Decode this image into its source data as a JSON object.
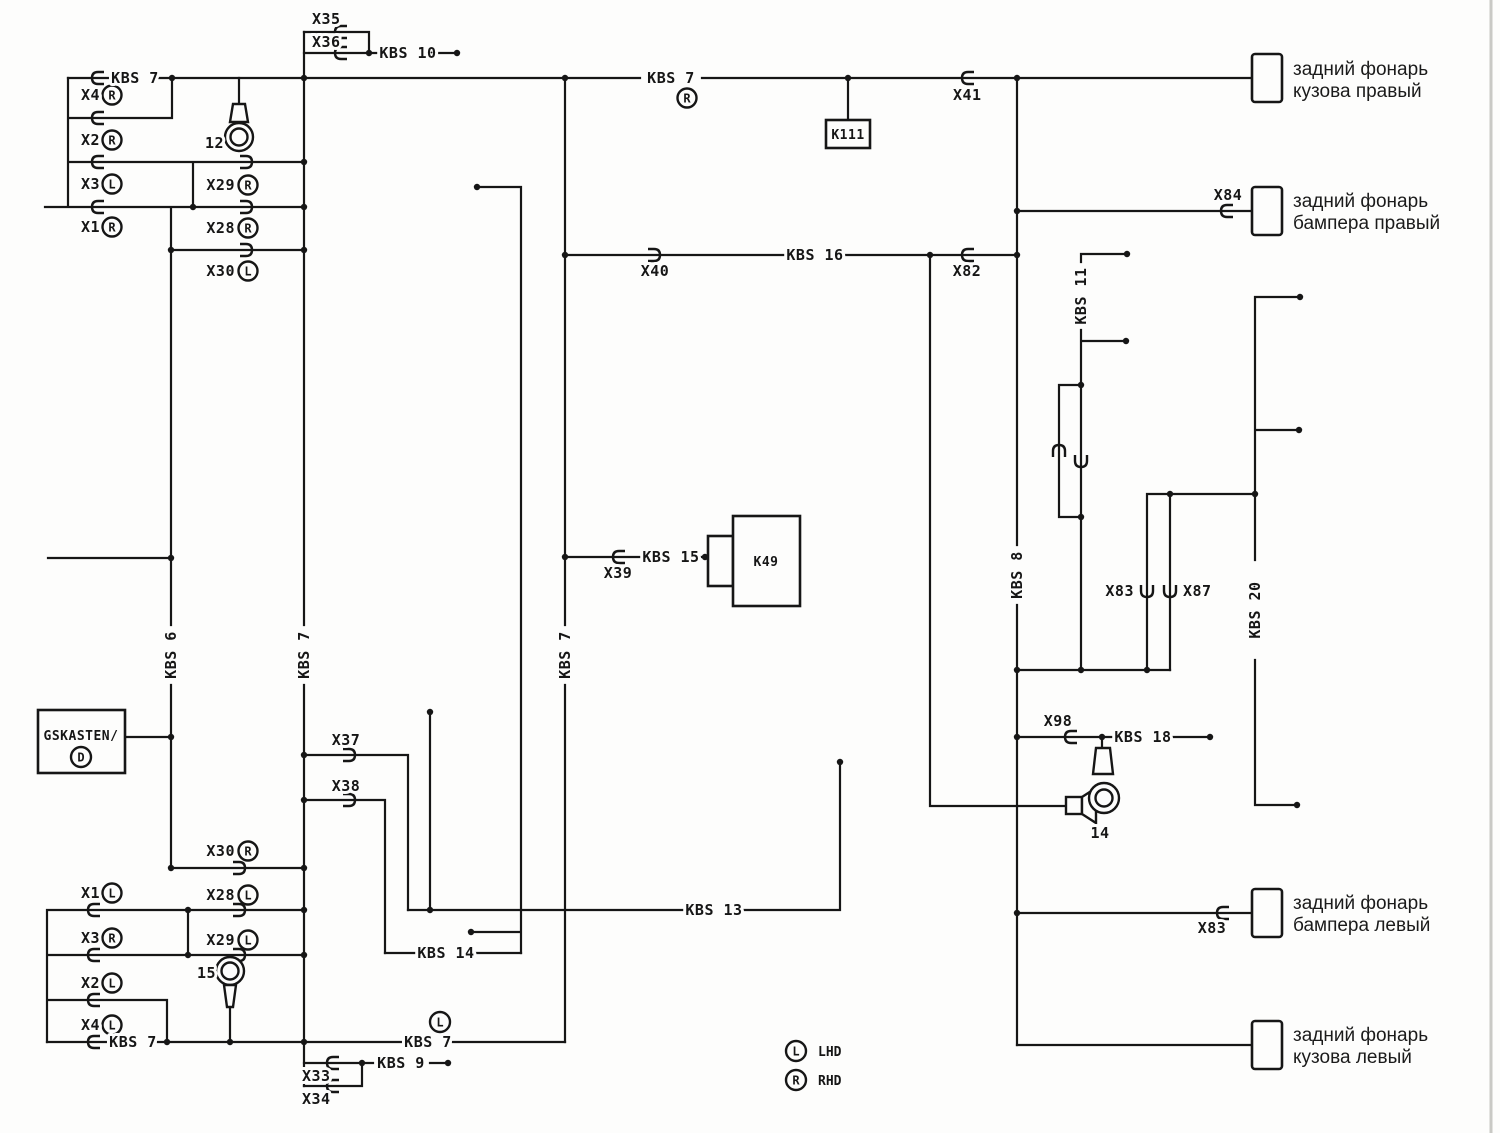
{
  "kbs": {
    "kbs6": "KBS 6",
    "kbs7": "KBS 7",
    "kbs8": "KBS 8",
    "kbs9": "KBS 9",
    "kbs10": "KBS 10",
    "kbs11": "KBS 11",
    "kbs13": "KBS 13",
    "kbs14": "KBS 14",
    "kbs15": "KBS 15",
    "kbs16": "KBS 16",
    "kbs18": "KBS 18",
    "kbs20": "KBS 20"
  },
  "connectors": {
    "x1": "X1",
    "x2": "X2",
    "x3": "X3",
    "x4": "X4",
    "x28": "X28",
    "x29": "X29",
    "x30": "X30",
    "x33": "X33",
    "x34": "X34",
    "x35": "X35",
    "x36": "X36",
    "x37": "X37",
    "x38": "X38",
    "x39": "X39",
    "x40": "X40",
    "x41": "X41",
    "x82": "X82",
    "x83": "X83",
    "x84": "X84",
    "x87": "X87",
    "x98": "X98"
  },
  "components": {
    "k111": "K111",
    "k49": "K49",
    "bulb12": "12",
    "bulb15": "15",
    "ring14": "14",
    "gskasten": "GSKASTEN/"
  },
  "letters": {
    "r": "R",
    "l": "L",
    "d": "D"
  },
  "lamps": {
    "body_right": {
      "line1": "задний фонарь",
      "line2": "кузова правый"
    },
    "bumper_right": {
      "line1": "задний фонарь",
      "line2": "бампера правый"
    },
    "bumper_left": {
      "line1": "задний фонарь",
      "line2": "бампера левый"
    },
    "body_left": {
      "line1": "задний фонарь",
      "line2": "кузова левый"
    }
  },
  "legend": {
    "l": "L",
    "lhd": "LHD",
    "r": "R",
    "rhd": "RHD"
  },
  "colors": {
    "ink": "#161616",
    "paper": "#fdfdfc"
  }
}
